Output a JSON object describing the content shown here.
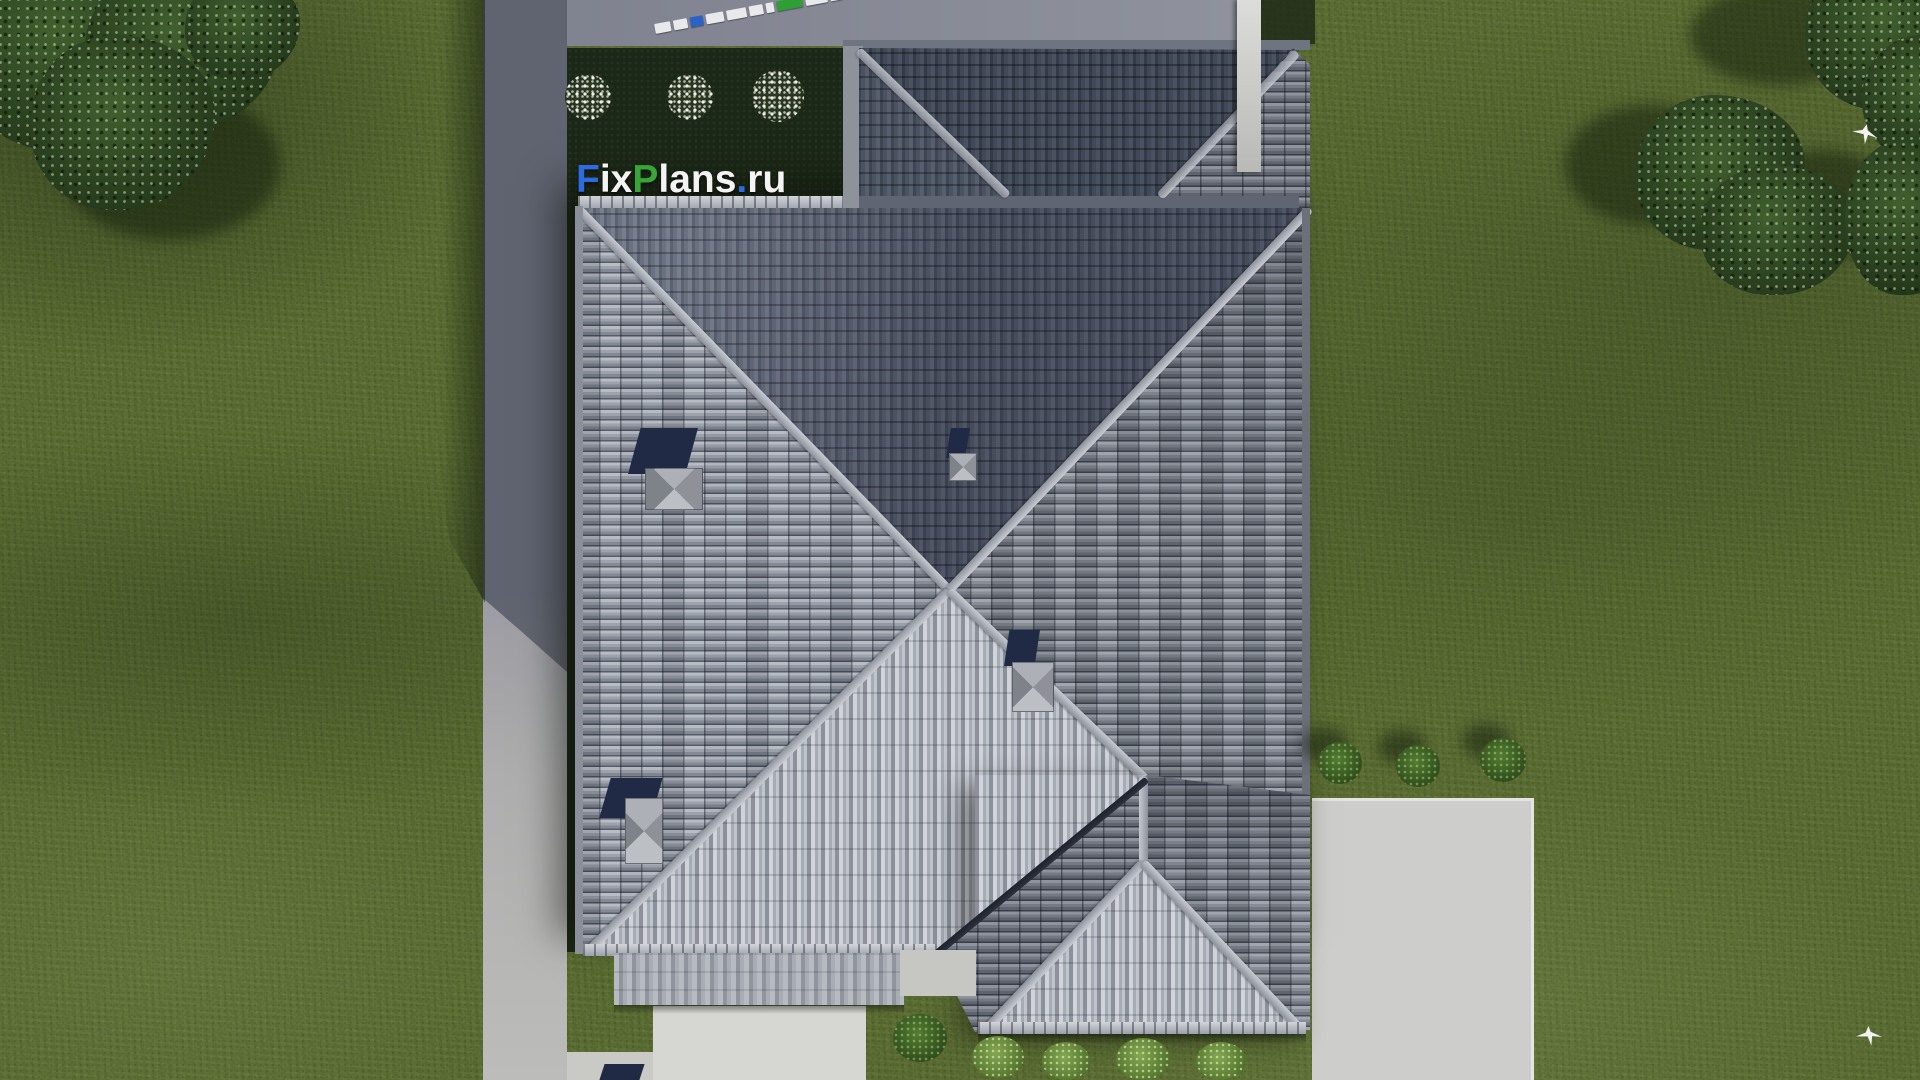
{
  "scene": {
    "title": "Aerial top-down 3D render of a hip-roof house with lawn, driveway and patio",
    "width": 1920,
    "height": 1080
  },
  "watermark": {
    "full_text": "FixPlans.ru",
    "parts": [
      {
        "text": "F",
        "color": "#2e6bdf"
      },
      {
        "text": "ix",
        "color": "#f4f4f4"
      },
      {
        "text": "P",
        "color": "#37a637"
      },
      {
        "text": "lans",
        "color": "#f4f4f4"
      },
      {
        "text": ".",
        "color": "#2e6bdf"
      },
      {
        "text": "ru",
        "color": "#f4f4f4"
      }
    ]
  },
  "top_strip": {
    "blocks": [
      "#e9e9ec",
      "#e9e9ec",
      "#2b62c8",
      "#e9e9ec",
      "#e9e9ec",
      "#e9e9ec",
      "#e9e9ec",
      "#2f9e35",
      "#e9e9ec",
      "#e9e9ec",
      "#2f9e35",
      "#2b62c8"
    ]
  },
  "palette": {
    "grass": "#5a6c31",
    "grass_dark": "#1f2b18",
    "garden_bed": "#1c2817",
    "driveway": "#a3a3a9",
    "walkway": "#d6d6d2",
    "patio": "#cdcdcb",
    "roof_bright": "#c3c6cd",
    "roof_light": "#9ba0ab",
    "roof_mid": "#7e8490",
    "roof_dark": "#4d5464",
    "ridge": "#b4b8bf",
    "valley": "#262b35",
    "navy": "#212a44",
    "vent": "#a9acb2",
    "chimney_white": "#dcdcd8",
    "bush_green": "#4e7a2f",
    "bush_light": "#7da04b",
    "flower_white": "#eef1ea",
    "bird": "#f2f2f0"
  }
}
